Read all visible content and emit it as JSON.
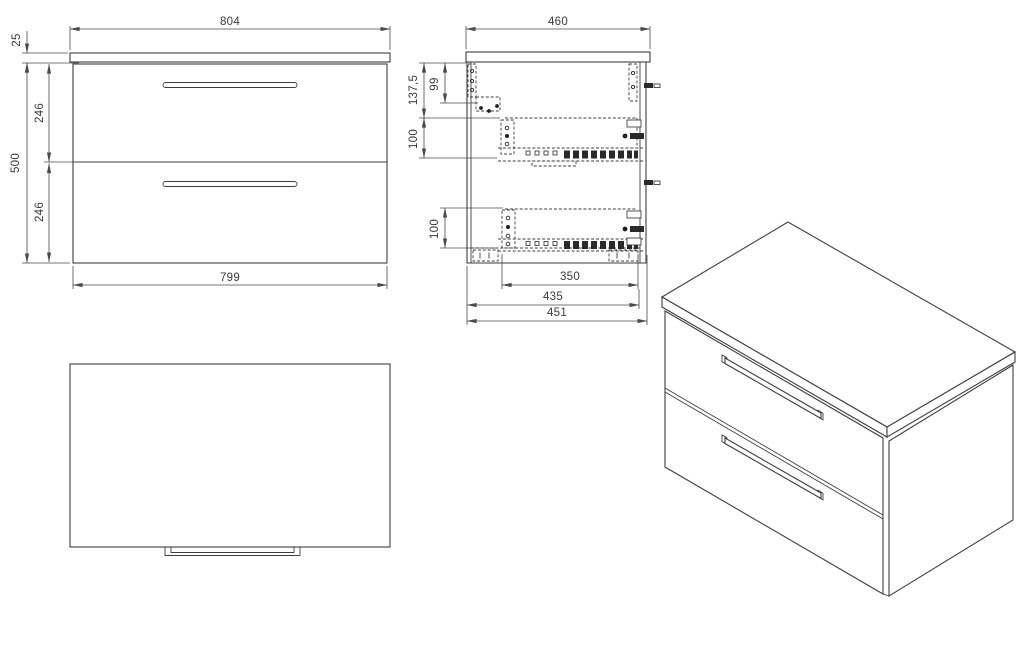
{
  "colors": {
    "background": "#ffffff",
    "line": "#3e3e3e",
    "text": "#3a3a3a"
  },
  "views": {
    "front": {
      "dims": {
        "width_top": "804",
        "countertop_thickness": "25",
        "height_total": "500",
        "drawer_upper_height": "246",
        "drawer_lower_height": "246",
        "width_carcass": "799"
      }
    },
    "side": {
      "dims": {
        "depth_top": "460",
        "fixing_offset": "137,5",
        "bracket_offset": "99",
        "slide_offset_upper": "100",
        "slide_offset_lower": "100",
        "slide_length": "350",
        "depth_inner": "435",
        "depth_carcass": "451"
      }
    }
  }
}
